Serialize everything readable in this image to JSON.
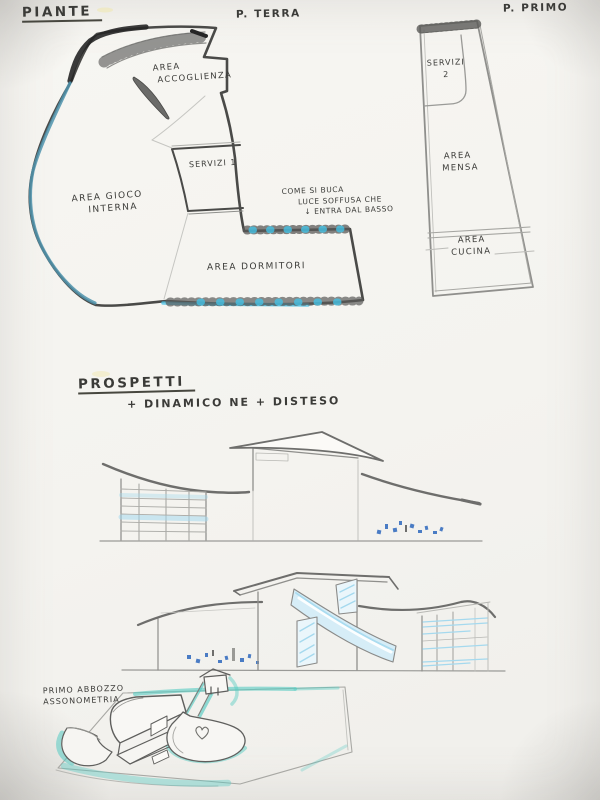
{
  "header": {
    "title": "PIANTE",
    "ground_floor_label": "P. TERRA",
    "first_floor_label": "P. PRIMO"
  },
  "ground_floor_plan": {
    "area_accoglienza": [
      "AREA",
      "ACCOGLIENZA"
    ],
    "servizi_1": "SERVIZI 1",
    "area_gioco": [
      "AREA  GIOCO",
      "INTERNA"
    ],
    "area_dormitori": "AREA  DORMITORI",
    "note": [
      "COME SI BUCA",
      "LUCE SOFFUSA CHE",
      "↓ ENTRA DAL BASSO"
    ]
  },
  "first_floor_plan": {
    "servizi_2": [
      "SERVIZI",
      "2"
    ],
    "area_mensa": [
      "AREA",
      "MENSA"
    ],
    "area_cucina": [
      "AREA",
      "CUCINA"
    ]
  },
  "elevations": {
    "heading": "PROSPETTI",
    "subheading": "+ DINAMICO   NE + DISTESO"
  },
  "axonometric": {
    "caption": [
      "PRIMO ABBOZZO",
      "ASSONOMETRIA"
    ]
  },
  "colors": {
    "paper": "#f4f3ef",
    "pencil-dark": "#4a4a48",
    "ink-heavy": "#262626",
    "handwriting": "#3b3b38",
    "cyan": "#45c0e4",
    "teal": "#55cbc2",
    "teal-edge": "#4f93ad",
    "glass-blue": "#a5d9ee",
    "scribble-blue": "#4a7cc4"
  }
}
